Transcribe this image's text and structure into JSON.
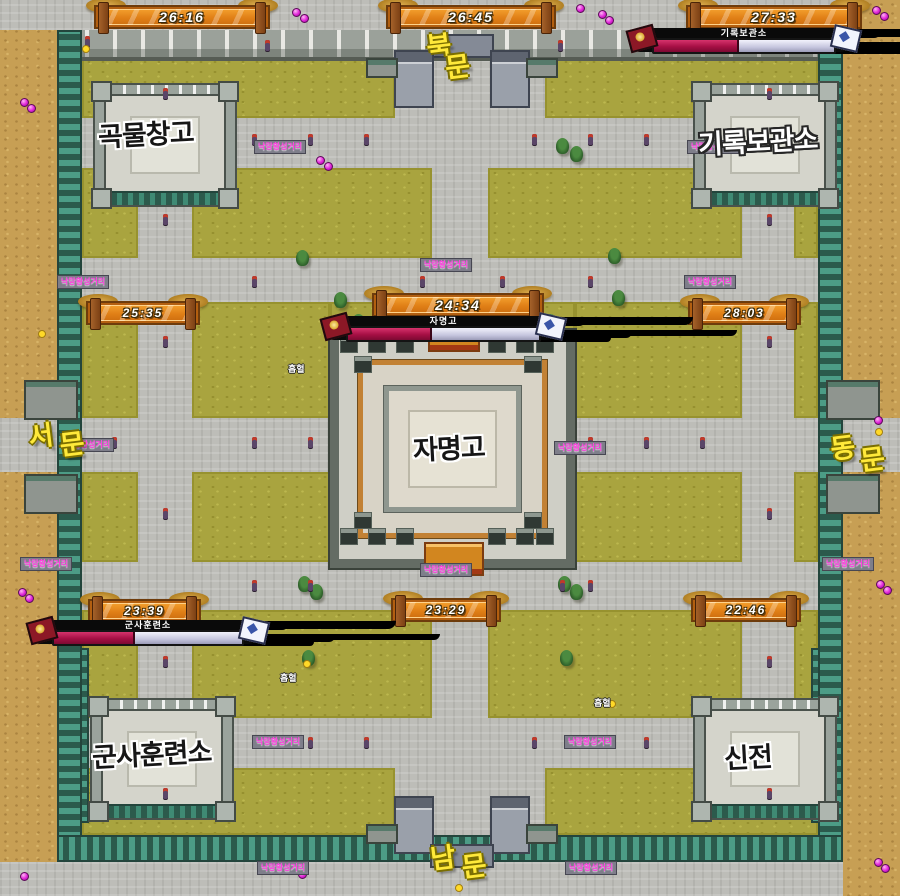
{
  "timers": [
    {
      "id": "timer-nw",
      "time": "26:16",
      "x": 94,
      "y": 5,
      "w": 176
    },
    {
      "id": "timer-n",
      "time": "26:45",
      "x": 386,
      "y": 5,
      "w": 170
    },
    {
      "id": "timer-ne",
      "time": "27:33",
      "x": 686,
      "y": 5,
      "w": 176
    },
    {
      "id": "timer-w",
      "time": "25:35",
      "x": 86,
      "y": 301,
      "w": 114
    },
    {
      "id": "timer-center",
      "time": "24:34",
      "x": 372,
      "y": 293,
      "w": 172
    },
    {
      "id": "timer-e",
      "time": "28:03",
      "x": 688,
      "y": 301,
      "w": 113
    },
    {
      "id": "timer-sw",
      "time": "23:39",
      "x": 88,
      "y": 599,
      "w": 113
    },
    {
      "id": "timer-s",
      "time": "23:29",
      "x": 391,
      "y": 598,
      "w": 110
    },
    {
      "id": "timer-se",
      "time": "22:46",
      "x": 691,
      "y": 598,
      "w": 110
    }
  ],
  "boss_bars": [
    {
      "label": "기록보관소",
      "fill_pct": 46,
      "x": 628,
      "y": 24,
      "w": 232
    },
    {
      "label": "자명고",
      "fill_pct": 43,
      "x": 322,
      "y": 312,
      "w": 243
    },
    {
      "label": "군사훈련소",
      "fill_pct": 42,
      "x": 28,
      "y": 616,
      "w": 240
    }
  ],
  "gate_labels": [
    {
      "text": "북문",
      "x": 424,
      "y": 26,
      "dx": 16,
      "dy": 23
    },
    {
      "text": "서문",
      "x": 26,
      "y": 416,
      "dx": 30,
      "dy": 12
    },
    {
      "text": "동문",
      "x": 828,
      "y": 428,
      "dx": 28,
      "dy": 15
    },
    {
      "text": "남문",
      "x": 428,
      "y": 838,
      "dx": 30,
      "dy": 12
    }
  ],
  "building_labels": [
    {
      "text": "곡물창고",
      "x": 98,
      "y": 113,
      "style": "dark"
    },
    {
      "text": "기록보관소",
      "x": 698,
      "y": 120,
      "style": "light"
    },
    {
      "text": "자명고",
      "x": 413,
      "y": 427,
      "style": "dark"
    },
    {
      "text": "군사훈련소",
      "x": 92,
      "y": 733,
      "style": "dark"
    },
    {
      "text": "신전",
      "x": 724,
      "y": 736,
      "style": "dark"
    }
  ],
  "signposts": [
    {
      "text": "낙랑황성거리",
      "x": 254,
      "y": 140
    },
    {
      "text": "낙랑황성거리",
      "x": 687,
      "y": 140
    },
    {
      "text": "낙랑황성거리",
      "x": 57,
      "y": 275
    },
    {
      "text": "낙랑황성거리",
      "x": 420,
      "y": 258
    },
    {
      "text": "낙랑황성거리",
      "x": 684,
      "y": 275
    },
    {
      "text": "낙랑황성거리",
      "x": 62,
      "y": 438
    },
    {
      "text": "낙랑황성거리",
      "x": 554,
      "y": 441
    },
    {
      "text": "낙랑황성거리",
      "x": 20,
      "y": 557
    },
    {
      "text": "낙랑황성거리",
      "x": 420,
      "y": 563
    },
    {
      "text": "낙랑황성거리",
      "x": 822,
      "y": 557
    },
    {
      "text": "낙랑황성거리",
      "x": 252,
      "y": 735
    },
    {
      "text": "낙랑황성거리",
      "x": 564,
      "y": 735
    },
    {
      "text": "낙랑황성거리",
      "x": 257,
      "y": 861
    },
    {
      "text": "낙랑황성거리",
      "x": 565,
      "y": 861
    }
  ],
  "mob_labels": [
    {
      "text": "흡혈",
      "x": 288,
      "y": 362
    },
    {
      "text": "흡혈",
      "x": 280,
      "y": 671
    },
    {
      "text": "흡혈",
      "x": 594,
      "y": 696
    }
  ],
  "markers": {
    "orbs": [
      [
        292,
        8
      ],
      [
        300,
        14
      ],
      [
        576,
        4
      ],
      [
        598,
        10
      ],
      [
        605,
        16
      ],
      [
        872,
        6
      ],
      [
        880,
        12
      ],
      [
        20,
        98
      ],
      [
        27,
        104
      ],
      [
        316,
        156
      ],
      [
        324,
        162
      ],
      [
        398,
        306
      ],
      [
        18,
        588
      ],
      [
        25,
        594
      ],
      [
        874,
        416
      ],
      [
        876,
        580
      ],
      [
        883,
        586
      ],
      [
        290,
        864
      ],
      [
        298,
        870
      ],
      [
        604,
        864
      ],
      [
        874,
        858
      ],
      [
        881,
        864
      ],
      [
        20,
        872
      ]
    ],
    "dots": [
      [
        82,
        45
      ],
      [
        834,
        43
      ],
      [
        38,
        330
      ],
      [
        875,
        428
      ],
      [
        303,
        660
      ],
      [
        608,
        700
      ],
      [
        455,
        884
      ]
    ]
  },
  "decor": {
    "trees": [
      [
        352,
        314
      ],
      [
        544,
        314
      ],
      [
        334,
        292
      ],
      [
        612,
        290
      ],
      [
        298,
        576
      ],
      [
        310,
        584
      ],
      [
        558,
        576
      ],
      [
        570,
        584
      ],
      [
        556,
        138
      ],
      [
        570,
        146
      ],
      [
        296,
        250
      ],
      [
        608,
        248
      ],
      [
        302,
        650
      ],
      [
        560,
        650
      ]
    ],
    "lanterns": [
      [
        252,
        134
      ],
      [
        308,
        134
      ],
      [
        364,
        134
      ],
      [
        532,
        134
      ],
      [
        588,
        134
      ],
      [
        644,
        134
      ],
      [
        252,
        276
      ],
      [
        420,
        276
      ],
      [
        500,
        276
      ],
      [
        588,
        276
      ],
      [
        112,
        437
      ],
      [
        252,
        437
      ],
      [
        308,
        437
      ],
      [
        588,
        437
      ],
      [
        644,
        437
      ],
      [
        700,
        437
      ],
      [
        252,
        580
      ],
      [
        308,
        580
      ],
      [
        560,
        580
      ],
      [
        588,
        580
      ],
      [
        252,
        737
      ],
      [
        308,
        737
      ],
      [
        364,
        737
      ],
      [
        532,
        737
      ],
      [
        588,
        737
      ],
      [
        644,
        737
      ],
      [
        163,
        88
      ],
      [
        163,
        214
      ],
      [
        163,
        336
      ],
      [
        163,
        508
      ],
      [
        163,
        656
      ],
      [
        163,
        788
      ],
      [
        767,
        88
      ],
      [
        767,
        214
      ],
      [
        767,
        336
      ],
      [
        767,
        508
      ],
      [
        767,
        656
      ],
      [
        767,
        788
      ],
      [
        85,
        36
      ],
      [
        265,
        40
      ],
      [
        558,
        40
      ],
      [
        630,
        38
      ]
    ]
  },
  "colors": {
    "banner_orange": "#e07f16",
    "bar_crimson": "#a60f44",
    "grass_olive": "#a9a43f",
    "dirt_tan": "#c79f54",
    "wall_teal": "#4c9c86",
    "road_gray": "#bdbdb8",
    "gate_label_yellow": "#ffe93a",
    "marker_magenta": "#e024d8"
  }
}
